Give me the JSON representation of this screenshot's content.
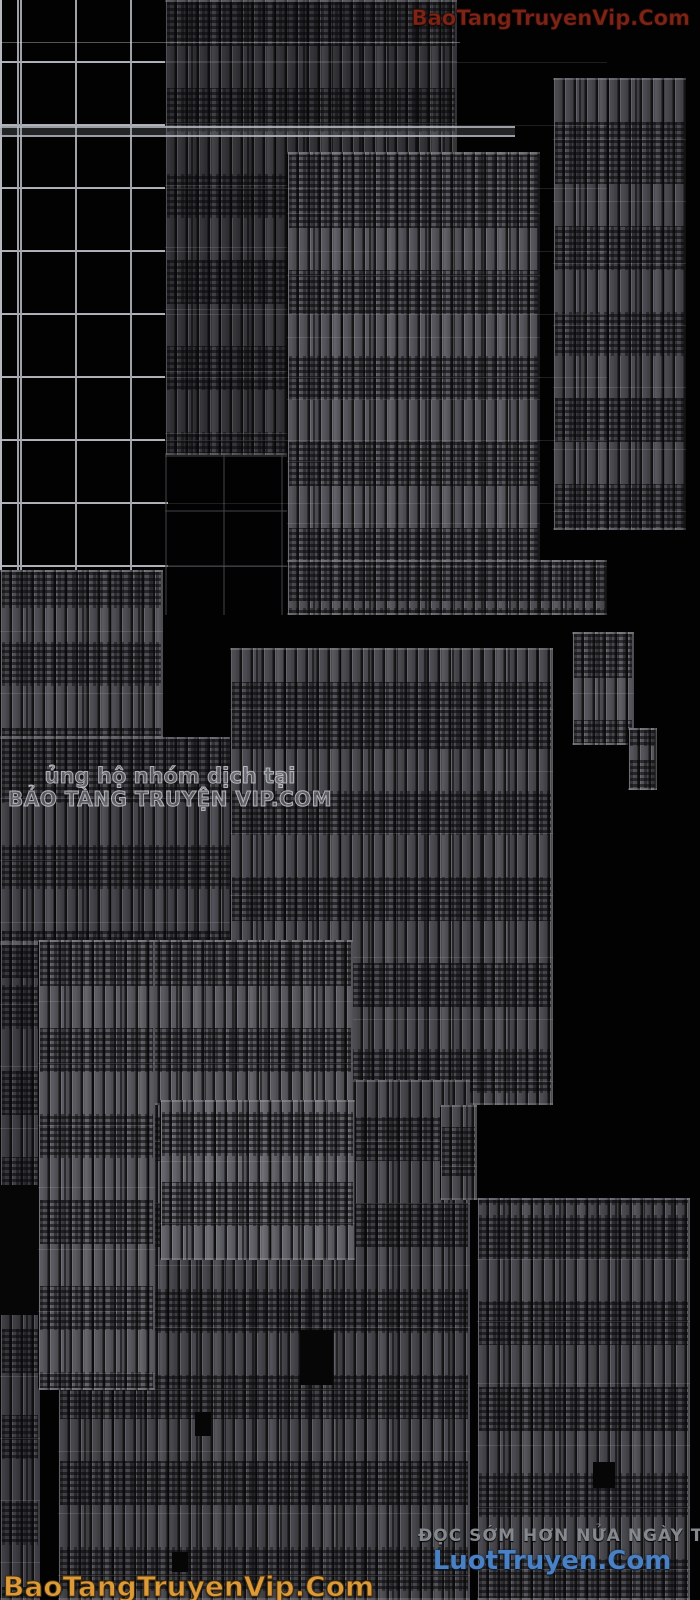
{
  "scene": {
    "background_color": "#020203"
  },
  "watermarks": {
    "top_right": {
      "text": "BaoTangTruyenVip.Com",
      "color": "#7d2417"
    },
    "mid_left": {
      "line1": "ủng hộ nhóm dịch tại",
      "line2": "BẢO TÀNG TRUYỆN VIP.COM",
      "color": "#c9c9cf"
    },
    "bottom_left": {
      "text": "BaoTangTruyenVip.Com",
      "color": "#dd9a39"
    },
    "bottom_right": {
      "line1": "ĐỌC SỚM HƠN NỬA NGÀY TẠI",
      "line2": "LuotTruyen.Com",
      "line1_color": "#85898e",
      "line2_color": "#4a80c4"
    }
  }
}
